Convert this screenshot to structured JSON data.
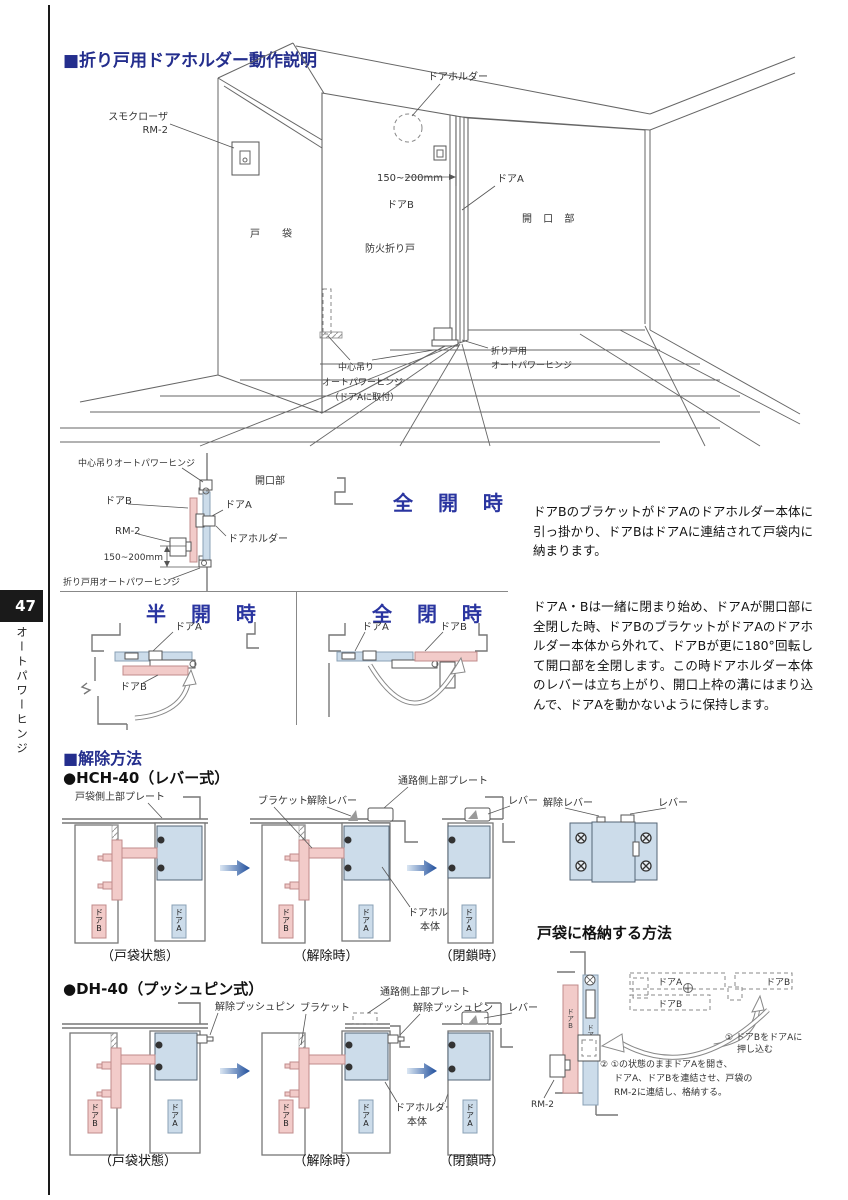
{
  "colors": {
    "accent": "#242e8d",
    "door_pink": "#f2cbc9",
    "door_blue": "#ccdcea",
    "arrow_dark": "#1f4e9c",
    "tab_black": "#1a1a1a"
  },
  "page": {
    "number": "47",
    "sidebar": "オートパワーヒンジ"
  },
  "s1": {
    "title": "■折り戸用ドアホルダー動作説明",
    "closer1": "スモクローザ",
    "closer2": "RM-2",
    "holder": "ドアホルダー",
    "dim": "150~200mm",
    "door_a": "ドアA",
    "door_b": "ドアB",
    "opening": "開 口 部",
    "pocket": "戸　袋",
    "fire_door": "防火折り戸",
    "center1": "中心吊り",
    "center2": "オートパワーヒンジ",
    "center3": "（ドアAに取付）",
    "fold1": "折り戸用",
    "fold2": "オートパワーヒンジ"
  },
  "open_state": {
    "title": "全 開 時",
    "center_hinge": "中心吊りオートパワーヒンジ",
    "door_b": "ドアB",
    "rm2": "RM-2",
    "dim": "150~200mm",
    "fold_hinge": "折り戸用オートパワーヒンジ",
    "opening": "開口部",
    "door_a": "ドアA",
    "holder": "ドアホルダー",
    "body": "ドアBのブラケットがドアAのドアホルダー本体に引っ掛かり、ドアBはドアAに連結されて戸袋内に納まります。"
  },
  "half_state": {
    "title": "半 開 時",
    "door_a": "ドアA",
    "door_b": "ドアB"
  },
  "closed_state": {
    "title": "全 閉 時",
    "door_a": "ドアA",
    "door_b": "ドアB",
    "body": "ドアA・Bは一緒に閉まり始め、ドアAが開口部に全閉した時、ドアBのブラケットがドアAのドアホルダー本体から外れて、ドアBが更に180°回転して開口部を全閉します。この時ドアホルダー本体のレバーは立ち上がり、開口上枠の溝にはまり込んで、ドアAを動かないように保持します。"
  },
  "release": {
    "title": "■解除方法",
    "hch40": "●HCH-40（レバー式）",
    "dh40": "●DH-40（プッシュピン式）",
    "pocket_plate": "戸袋側上部プレート",
    "bracket": "ブラケット",
    "release_lever": "解除レバー",
    "aisle_plate": "通路側上部プレート",
    "lever": "レバー",
    "holder1": "ドアホルダー",
    "holder2": "本体",
    "pin": "解除プッシュピン",
    "cap_pocket": "（戸袋状態）",
    "cap_release": "（解除時）",
    "cap_closed": "（閉鎖時）",
    "tag_a": "ドアA",
    "tag_b": "ドアB"
  },
  "storage": {
    "title": "戸袋に格納する方法",
    "door_a": "ドアA",
    "door_b": "ドアB",
    "step1a": "① ドアBをドアAに",
    "step1b": "押し込む",
    "step2a": "② ①の状態のままドアAを開き、",
    "step2b": "ドアA、ドアBを連結させ、戸袋の",
    "step2c": "RM-2に連結し、格納する。",
    "rm2": "RM-2"
  }
}
